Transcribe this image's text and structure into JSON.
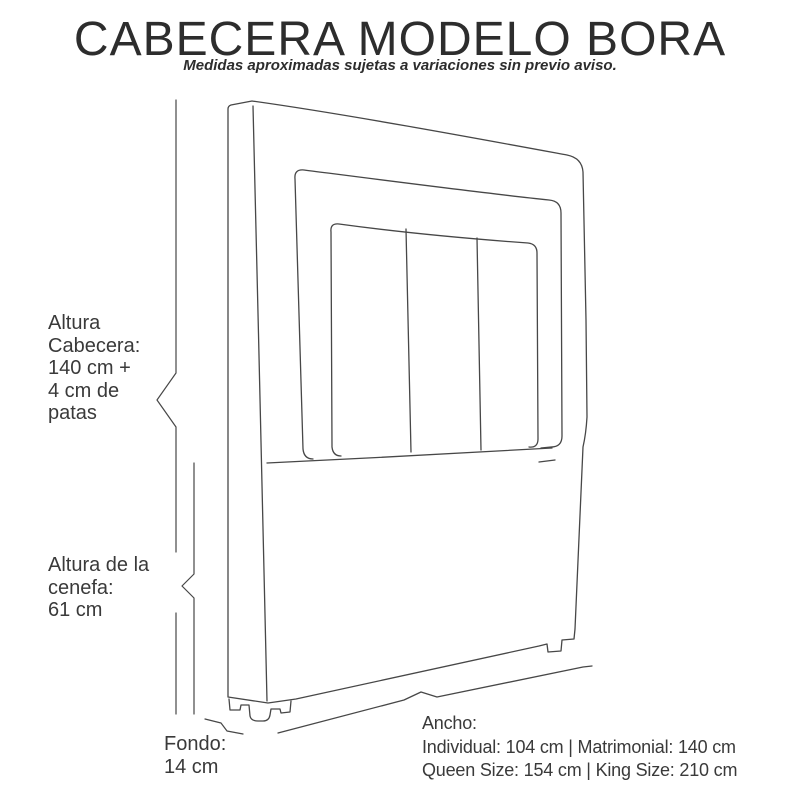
{
  "header": {
    "title": "CABECERA MODELO BORA",
    "subtitle": "Medidas aproximadas sujetas a variaciones sin previo aviso."
  },
  "labels": {
    "altura_cabecera": "Altura\nCabecera:\n140 cm +\n4 cm de\npatas",
    "altura_cenefa": "Altura de la\ncenefa:\n61 cm",
    "fondo": "Fondo:\n14 cm",
    "ancho": {
      "title": "Ancho:",
      "line1": "Individual: 104 cm | Matrimonial: 140 cm",
      "line2": "Queen Size: 154 cm | King Size: 210 cm"
    }
  },
  "colors": {
    "background": "#ffffff",
    "text": "#3a3a3a",
    "title_text": "#2d2d2d",
    "drawing_line": "#474747"
  }
}
